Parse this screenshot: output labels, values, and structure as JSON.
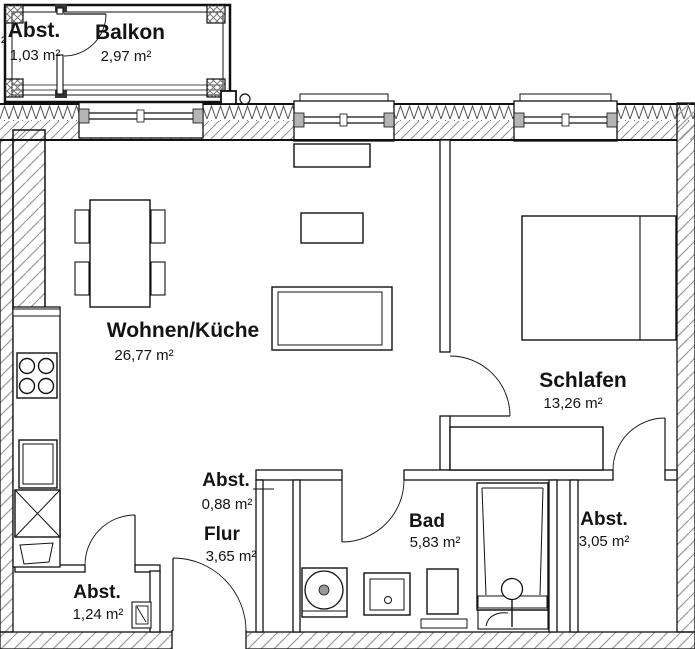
{
  "rooms": {
    "balkon_abst": {
      "name": "Abst.",
      "area": "1,03 m²"
    },
    "balkon": {
      "name": "Balkon",
      "area": "2,97 m²"
    },
    "wohnen": {
      "name": "Wohnen/Küche",
      "area": "26,77 m²"
    },
    "schlafen": {
      "name": "Schlafen",
      "area": "13,26 m²"
    },
    "abst_flur": {
      "name": "Abst.",
      "area": "0,88 m²"
    },
    "flur": {
      "name": "Flur",
      "area": "3,65 m²"
    },
    "bad": {
      "name": "Bad",
      "area": "5,83 m²"
    },
    "abst_rechts": {
      "name": "Abst.",
      "area": "3,05 m²"
    },
    "abst_unten": {
      "name": "Abst.",
      "area": "1,24 m²"
    }
  },
  "edge_text_fragment": "²",
  "fixtures": {
    "kitchen": [
      "stove-icon",
      "sink-icon",
      "appliance-x-icon",
      "counter"
    ],
    "bath": [
      "washing-machine-icon",
      "washbasin-icon",
      "toilet-icon",
      "bathtub-icon",
      "faucet-icon"
    ],
    "living": [
      "dining-table",
      "chair",
      "sofa",
      "sideboard",
      "coffee-table"
    ],
    "bedroom": [
      "double-bed",
      "wardrobe"
    ]
  },
  "colors": {
    "line": "#111111",
    "hatch_gray": "#9b9b9b",
    "zigzag": "#4f4f4f",
    "window_jamb": "#b5b5b5",
    "background": "#ffffff"
  }
}
